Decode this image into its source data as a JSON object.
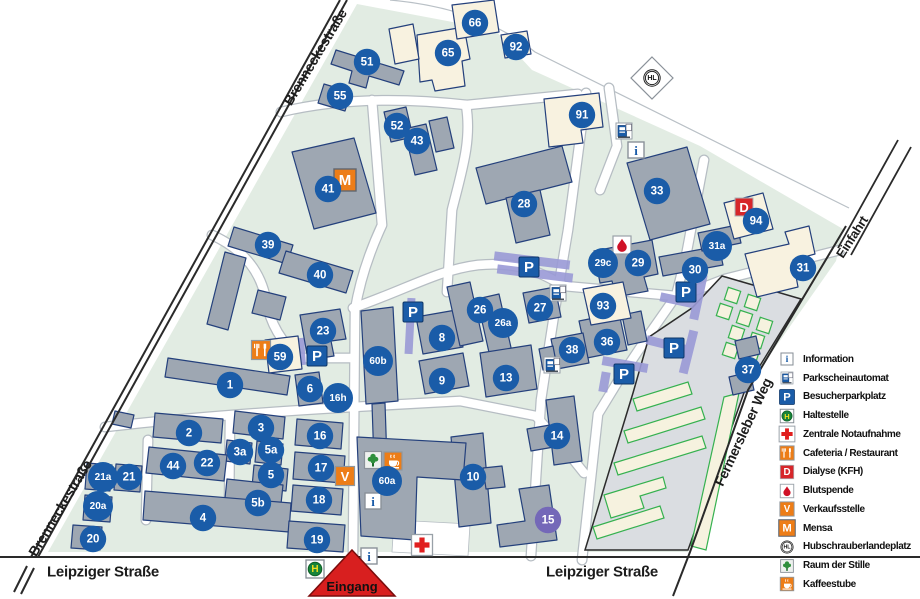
{
  "colors": {
    "campus_green": "#e2ece3",
    "building_gray": "#9ea7b2",
    "building_cream": "#f8f2e0",
    "outline_blue": "#24407c",
    "circle_blue": "#1a5ca8",
    "circle_purple": "#7468b8",
    "parking_purple": "#9a9ad6",
    "parking_lot_gray": "#dadde1",
    "parking_green_outline": "#35b14f",
    "orange": "#ed7d17",
    "red": "#d7262a",
    "road_casing": "#b6bdc3",
    "street_line": "#2a2a2a",
    "entrance_red": "#d81f1f"
  },
  "streets": {
    "labels": [
      {
        "text": "Brenneckestraße",
        "x": 315,
        "y": 57,
        "angle": -59,
        "size": 14
      },
      {
        "text": "Brenneckestraße",
        "x": 60,
        "y": 508,
        "angle": -59,
        "size": 14
      },
      {
        "text": "Leipziger Straße",
        "x": 103,
        "y": 572,
        "angle": 0,
        "size": 15
      },
      {
        "text": "Leipziger Straße",
        "x": 602,
        "y": 572,
        "angle": 0,
        "size": 15
      },
      {
        "text": "Fermersleber Weg",
        "x": 743,
        "y": 432,
        "angle": -65,
        "size": 14
      },
      {
        "text": "Einfahrt",
        "x": 852,
        "y": 237,
        "angle": -57,
        "size": 13
      }
    ]
  },
  "entrance": {
    "label": "Eingang"
  },
  "buildings": {
    "markers": [
      {
        "label": "66",
        "x": 475,
        "y": 23
      },
      {
        "label": "92",
        "x": 516,
        "y": 47
      },
      {
        "label": "65",
        "x": 448,
        "y": 53
      },
      {
        "label": "51",
        "x": 367,
        "y": 62
      },
      {
        "label": "55",
        "x": 340,
        "y": 96
      },
      {
        "label": "91",
        "x": 582,
        "y": 115
      },
      {
        "label": "52",
        "x": 397,
        "y": 126
      },
      {
        "label": "43",
        "x": 417,
        "y": 141
      },
      {
        "label": "41",
        "x": 328,
        "y": 189
      },
      {
        "label": "33",
        "x": 657,
        "y": 191
      },
      {
        "label": "28",
        "x": 524,
        "y": 204
      },
      {
        "label": "94",
        "x": 756,
        "y": 221
      },
      {
        "label": "39",
        "x": 268,
        "y": 245
      },
      {
        "label": "31a",
        "x": 717,
        "y": 246
      },
      {
        "label": "40",
        "x": 320,
        "y": 275
      },
      {
        "label": "29c",
        "x": 603,
        "y": 263
      },
      {
        "label": "29",
        "x": 638,
        "y": 263
      },
      {
        "label": "30",
        "x": 695,
        "y": 270
      },
      {
        "label": "31",
        "x": 803,
        "y": 268
      },
      {
        "label": "23",
        "x": 323,
        "y": 331
      },
      {
        "label": "26",
        "x": 480,
        "y": 310
      },
      {
        "label": "26a",
        "x": 503,
        "y": 323
      },
      {
        "label": "27",
        "x": 540,
        "y": 308
      },
      {
        "label": "93",
        "x": 603,
        "y": 306
      },
      {
        "label": "59",
        "x": 280,
        "y": 357
      },
      {
        "label": "8",
        "x": 442,
        "y": 338
      },
      {
        "label": "36",
        "x": 607,
        "y": 342
      },
      {
        "label": "38",
        "x": 572,
        "y": 350
      },
      {
        "label": "60b",
        "x": 378,
        "y": 361
      },
      {
        "label": "1",
        "x": 230,
        "y": 385
      },
      {
        "label": "6",
        "x": 310,
        "y": 389
      },
      {
        "label": "16h",
        "x": 338,
        "y": 398
      },
      {
        "label": "9",
        "x": 442,
        "y": 381
      },
      {
        "label": "13",
        "x": 506,
        "y": 378
      },
      {
        "label": "37",
        "x": 748,
        "y": 370
      },
      {
        "label": "2",
        "x": 189,
        "y": 433
      },
      {
        "label": "3",
        "x": 261,
        "y": 428
      },
      {
        "label": "3a",
        "x": 240,
        "y": 452
      },
      {
        "label": "5a",
        "x": 271,
        "y": 450
      },
      {
        "label": "16",
        "x": 320,
        "y": 436
      },
      {
        "label": "44",
        "x": 173,
        "y": 466
      },
      {
        "label": "22",
        "x": 207,
        "y": 463
      },
      {
        "label": "21a",
        "x": 103,
        "y": 477
      },
      {
        "label": "21",
        "x": 129,
        "y": 477
      },
      {
        "label": "5",
        "x": 271,
        "y": 475
      },
      {
        "label": "17",
        "x": 321,
        "y": 468
      },
      {
        "label": "60a",
        "x": 387,
        "y": 481
      },
      {
        "label": "10",
        "x": 473,
        "y": 477
      },
      {
        "label": "14",
        "x": 557,
        "y": 436
      },
      {
        "label": "20a",
        "x": 98,
        "y": 506
      },
      {
        "label": "5b",
        "x": 258,
        "y": 503
      },
      {
        "label": "18",
        "x": 319,
        "y": 500
      },
      {
        "label": "15",
        "x": 548,
        "y": 520,
        "variant": "purple"
      },
      {
        "label": "4",
        "x": 203,
        "y": 518
      },
      {
        "label": "20",
        "x": 93,
        "y": 539
      },
      {
        "label": "19",
        "x": 317,
        "y": 540
      }
    ]
  },
  "map_icons": [
    {
      "type": "mensa",
      "x": 345,
      "y": 180
    },
    {
      "type": "dialyse",
      "x": 744,
      "y": 207
    },
    {
      "type": "blutspende",
      "x": 622,
      "y": 245
    },
    {
      "type": "parkautomat",
      "x": 624,
      "y": 131
    },
    {
      "type": "parkautomat",
      "x": 558,
      "y": 293
    },
    {
      "type": "parkautomat",
      "x": 552,
      "y": 365
    },
    {
      "type": "info",
      "x": 636,
      "y": 150
    },
    {
      "type": "info",
      "x": 373,
      "y": 501
    },
    {
      "type": "info",
      "x": 369,
      "y": 556
    },
    {
      "type": "parkplatz",
      "x": 529,
      "y": 267
    },
    {
      "type": "parkplatz",
      "x": 686,
      "y": 292
    },
    {
      "type": "parkplatz",
      "x": 413,
      "y": 312
    },
    {
      "type": "parkplatz",
      "x": 317,
      "y": 356
    },
    {
      "type": "parkplatz",
      "x": 674,
      "y": 348
    },
    {
      "type": "parkplatz",
      "x": 624,
      "y": 374
    },
    {
      "type": "cafeteria",
      "x": 261,
      "y": 350
    },
    {
      "type": "verkauf",
      "x": 345,
      "y": 476
    },
    {
      "type": "raum_stille",
      "x": 373,
      "y": 460
    },
    {
      "type": "kaffeestube",
      "x": 393,
      "y": 461
    },
    {
      "type": "notaufnahme",
      "x": 422,
      "y": 545
    },
    {
      "type": "haltestelle",
      "x": 315,
      "y": 569
    },
    {
      "type": "hubschrauber",
      "x": 652,
      "y": 78
    }
  ],
  "legend": {
    "items": [
      {
        "icon": "info",
        "label": "Information"
      },
      {
        "icon": "parkautomat",
        "label": "Parkscheinautomat"
      },
      {
        "icon": "parkplatz",
        "label": "Besucherparkplatz"
      },
      {
        "icon": "haltestelle",
        "label": "Haltestelle"
      },
      {
        "icon": "notaufnahme",
        "label": "Zentrale Notaufnahme"
      },
      {
        "icon": "cafeteria",
        "label": "Cafeteria / Restaurant"
      },
      {
        "icon": "dialyse",
        "label": "Dialyse (KFH)"
      },
      {
        "icon": "blutspende",
        "label": "Blutspende"
      },
      {
        "icon": "verkauf",
        "label": "Verkaufsstelle"
      },
      {
        "icon": "mensa",
        "label": "Mensa"
      },
      {
        "icon": "hubschrauber",
        "label": "Hubschrauberlandeplatz"
      },
      {
        "icon": "raum_stille",
        "label": "Raum der Stille"
      },
      {
        "icon": "kaffeestube",
        "label": "Kaffeestube"
      }
    ]
  }
}
